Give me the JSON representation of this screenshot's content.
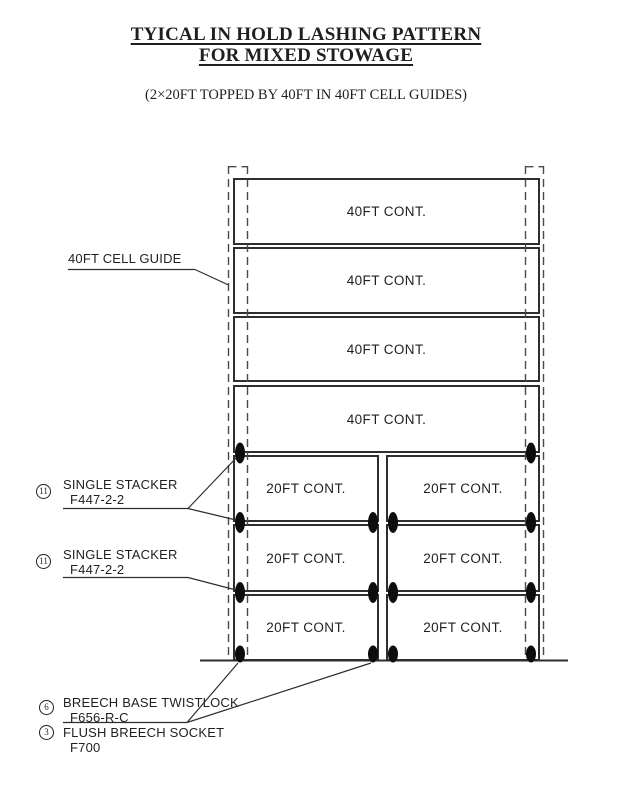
{
  "page": {
    "title_line1": "TYICAL IN HOLD LASHING PATTERN",
    "title_line2": "FOR MIXED STOWAGE",
    "subtitle": "(2×20FT TOPPED BY 40FT IN 40FT CELL GUIDES)"
  },
  "containers": {
    "forty": [
      {
        "label": "40FT CONT."
      },
      {
        "label": "40FT CONT."
      },
      {
        "label": "40FT CONT."
      },
      {
        "label": "40FT CONT."
      }
    ],
    "twenty": [
      {
        "label": "20FT CONT."
      },
      {
        "label": "20FT CONT."
      },
      {
        "label": "20FT CONT."
      },
      {
        "label": "20FT CONT."
      },
      {
        "label": "20FT CONT."
      },
      {
        "label": "20FT CONT."
      }
    ]
  },
  "annotations": {
    "cell_guide": {
      "label": "40FT CELL GUIDE"
    },
    "stacker_upper": {
      "ref_no": "11",
      "name": "SINGLE STACKER",
      "part_no": "F447-2-2"
    },
    "stacker_lower": {
      "ref_no": "11",
      "name": "SINGLE STACKER",
      "part_no": "F447-2-2"
    },
    "breech_base_twistlock": {
      "ref_no": "6",
      "name": "BREECH BASE TWISTLOCK",
      "part_no": "F656-R-C"
    },
    "flush_breech_socket": {
      "ref_no": "3",
      "name": "FLUSH BREECH SOCKET",
      "part_no": "F700"
    }
  },
  "colors": {
    "ink": "#1f1f1f",
    "line": "#2e2e2e",
    "dashed_line": "#4a4a4a",
    "fitting_fill": "#0d0d0d",
    "background": "#ffffff"
  }
}
